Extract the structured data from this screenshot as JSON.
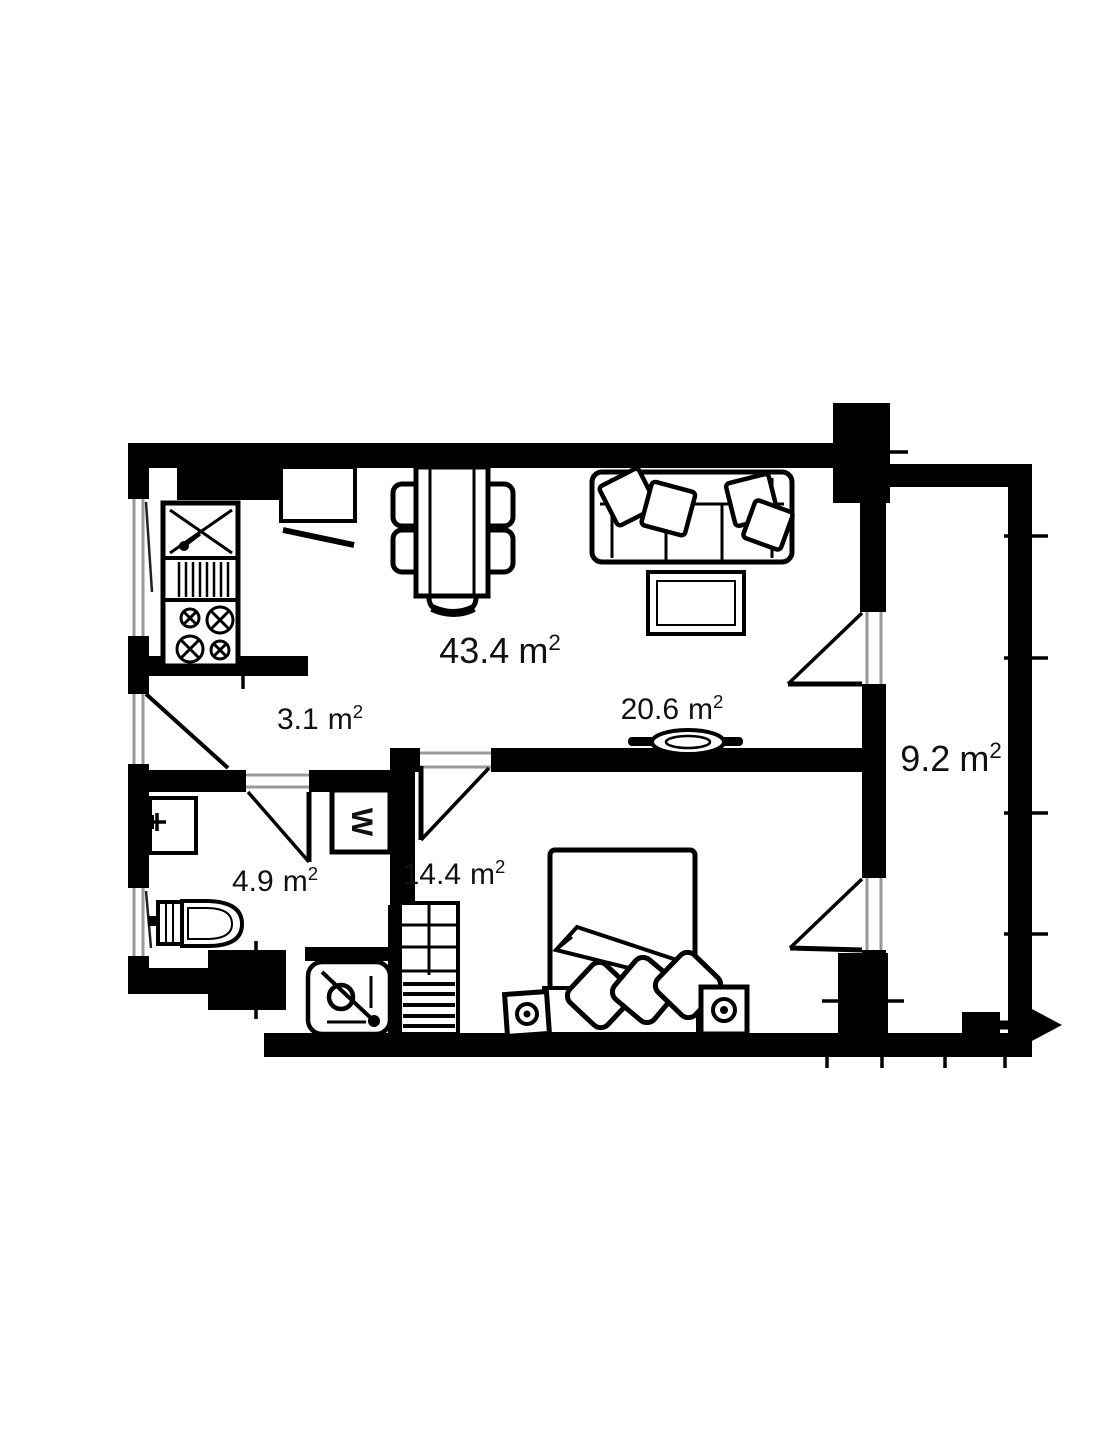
{
  "title": "Apartment floor plan",
  "rooms": [
    {
      "id": "living-room",
      "area": "43.4",
      "unit": "m",
      "sup": "2"
    },
    {
      "id": "hallway",
      "area": "3.1",
      "unit": "m",
      "sup": "2"
    },
    {
      "id": "living-zone",
      "area": "20.6",
      "unit": "m",
      "sup": "2"
    },
    {
      "id": "balcony",
      "area": "9.2",
      "unit": "m",
      "sup": "2"
    },
    {
      "id": "bathroom",
      "area": "4.9",
      "unit": "m",
      "sup": "2"
    },
    {
      "id": "bedroom",
      "area": "14.4",
      "unit": "m",
      "sup": "2"
    }
  ],
  "symbols": {
    "washing_machine": "W"
  },
  "colors": {
    "wall": "#000000",
    "background": "#ffffff",
    "window_frame": "#999999",
    "text": "#111111"
  }
}
